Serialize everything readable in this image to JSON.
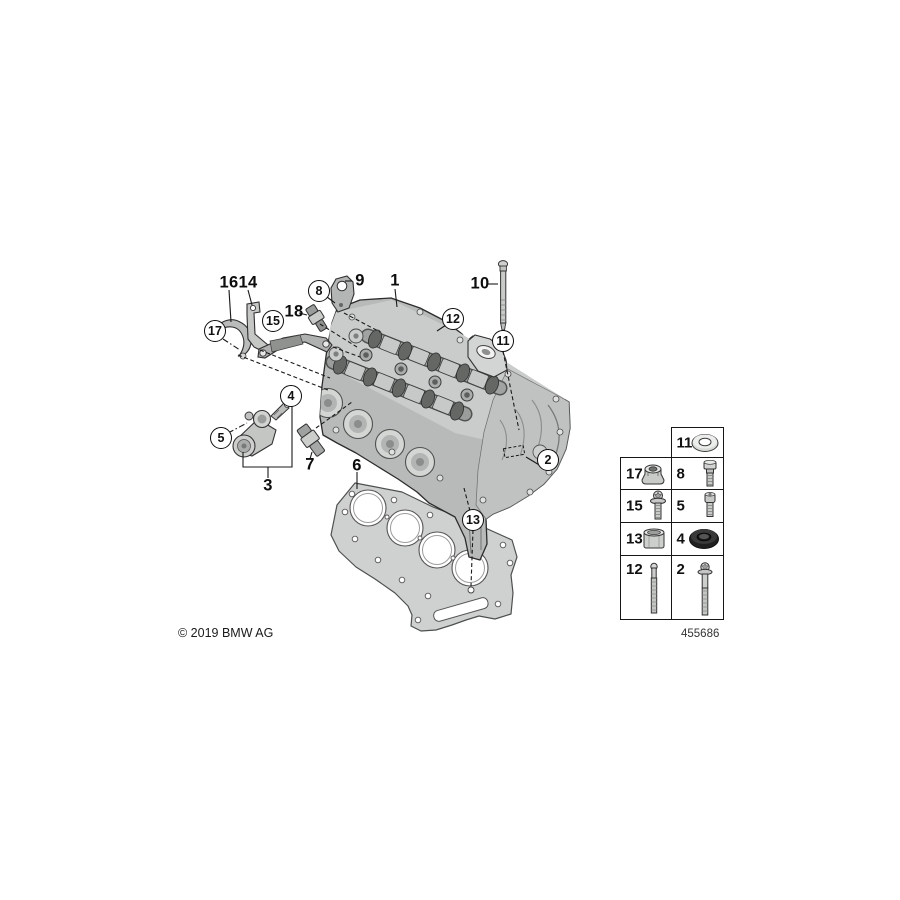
{
  "diagram": {
    "copyright": "© 2019 BMW AG",
    "id_label": "455686",
    "callouts": [
      {
        "label": "16",
        "type": "plain"
      },
      {
        "label": "14",
        "type": "plain"
      },
      {
        "label": "8",
        "type": "circled"
      },
      {
        "label": "9",
        "type": "plain"
      },
      {
        "label": "1",
        "type": "plain"
      },
      {
        "label": "10",
        "type": "plain"
      },
      {
        "label": "12",
        "type": "circled"
      },
      {
        "label": "11",
        "type": "circled"
      },
      {
        "label": "17",
        "type": "circled"
      },
      {
        "label": "15",
        "type": "circled"
      },
      {
        "label": "18",
        "type": "plain"
      },
      {
        "label": "4",
        "type": "circled"
      },
      {
        "label": "5",
        "type": "circled"
      },
      {
        "label": "3",
        "type": "plain"
      },
      {
        "label": "7",
        "type": "plain"
      },
      {
        "label": "6",
        "type": "plain"
      },
      {
        "label": "2",
        "type": "circled"
      },
      {
        "label": "13",
        "type": "circled"
      }
    ],
    "parts_table": {
      "cells": [
        {
          "label": "11",
          "icon": "washer-icon"
        },
        {
          "label": "17",
          "icon": "collar-nut-icon"
        },
        {
          "label": "8",
          "icon": "hex-bolt-icon"
        },
        {
          "label": "15",
          "icon": "flange-bolt-icon"
        },
        {
          "label": "5",
          "icon": "socket-head-bolt-icon"
        },
        {
          "label": "13",
          "icon": "sleeve-icon"
        },
        {
          "label": "4",
          "icon": "seal-ring-icon"
        },
        {
          "label": "12",
          "icon": "stud-icon"
        },
        {
          "label": "2",
          "icon": "long-flange-bolt-icon"
        }
      ]
    },
    "colors": {
      "line": "#1a1a1a",
      "metal_light": "#d9dbd9",
      "metal_mid": "#b5b8b6",
      "metal_dark": "#8a8d8b",
      "seal_black": "#1f1f1f"
    }
  }
}
